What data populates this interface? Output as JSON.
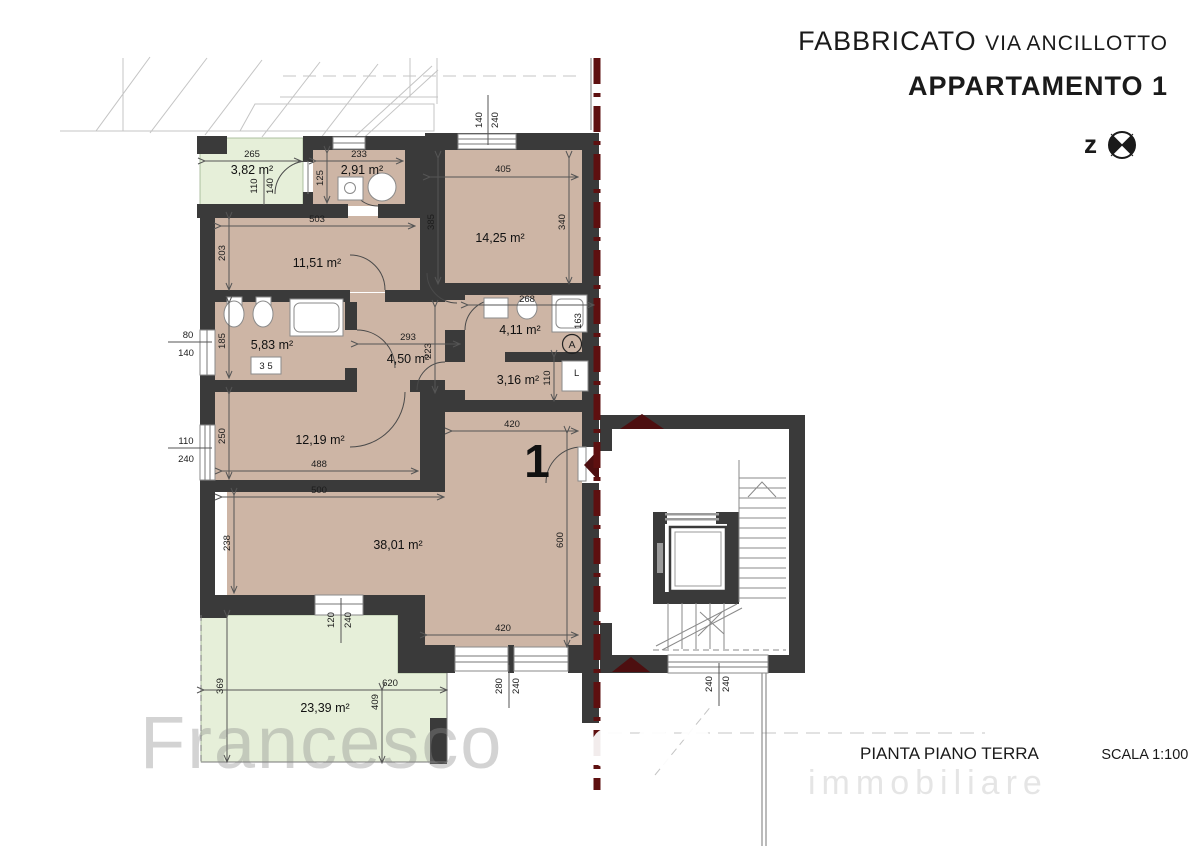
{
  "header": {
    "building": "FABBRICATO",
    "street": "VIA ANCILLOTTO",
    "apartment": "APPARTAMENTO 1",
    "north_letter": "z"
  },
  "footer": {
    "plan_title": "PIANTA PIANO TERRA",
    "scale_label": "SCALA 1:100"
  },
  "watermark": {
    "name_light": "Francesco",
    "name_bold": "Tacca",
    "sub": "immobiliare"
  },
  "unit": {
    "number": "1",
    "section_mark": "A"
  },
  "rooms": {
    "garden": "3,82 m²",
    "bath_top": "2,91 m²",
    "bedroom1": "14,25 m²",
    "bedroom2": "11,51 m²",
    "bath_main": "5,83 m²",
    "hall": "4,50 m²",
    "bath2": "4,11 m²",
    "storage": "3,16 m²",
    "bedroom3": "12,19 m²",
    "living": "38,01 m²",
    "terrace": "23,39 m²"
  },
  "fixtures": {
    "washer": "L",
    "radiator": "3 5"
  },
  "dims": {
    "garden_w": "265",
    "bath_top_w": "233",
    "bed1_w": "405",
    "bed1_h_l": "385",
    "bed1_h_r": "340",
    "bath_top_h": "125",
    "bed2_w": "503",
    "bed2_h": "203",
    "bath_main_h": "185",
    "hall_w": "293",
    "hall_h": "223",
    "bath2_w": "268",
    "bath2_h": "163",
    "storage_h": "110",
    "bed3_h": "250",
    "bed3_w": "488",
    "bed3_w2": "500",
    "living_w_top": "420",
    "living_h": "600",
    "living_h_l": "238",
    "living_w_bottom": "420",
    "terrace_h": "369",
    "terrace_w": "620",
    "terrace_h2": "409",
    "door_garden": [
      "110",
      "140"
    ],
    "win_left_top": [
      "80",
      "140"
    ],
    "win_left_bottom": [
      "110",
      "240"
    ],
    "win_top": [
      "140",
      "240"
    ],
    "win_terrace": [
      "120",
      "240"
    ],
    "win_living": [
      "280",
      "240"
    ],
    "win_stair": [
      "240",
      "240"
    ]
  },
  "colors": {
    "wall": "#3a3a3a",
    "room_fill": "#cdb5a5",
    "green_fill": "#e6efd9",
    "section_line": "#5e1010"
  }
}
